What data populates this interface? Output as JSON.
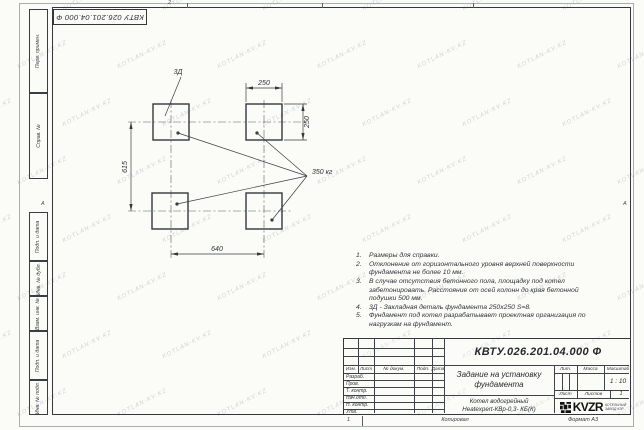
{
  "sheet": {
    "paper_color": "#fbfbf8",
    "line_color": "#3a3e42"
  },
  "stamp_top": {
    "text": "КВТУ 026.201.04.000 Ф"
  },
  "zones": {
    "top_number": "2",
    "left_letter": "А",
    "right_letter": "А"
  },
  "margin_fields": {
    "top": [
      "Перв. примен.",
      "Справ. №"
    ],
    "bottom": [
      "Подп. и дата",
      "Инв. № дубл.",
      "Взам. инв. №",
      "Подп. и дата",
      "Инв. № подл."
    ]
  },
  "drawing": {
    "embed_label": "3Д",
    "load_label": "350 кг",
    "dim_pad_width": "250",
    "dim_pad_height": "250",
    "dim_row_spacing": "615",
    "dim_col_spacing": "640"
  },
  "notes": {
    "items": [
      {
        "n": "1.",
        "text": "Размеры для справки."
      },
      {
        "n": "2.",
        "text": "Отклонение от горизонтального уровня верхней поверхности фундамента не более 10 мм."
      },
      {
        "n": "3.",
        "text": "В случае отсутствия бетонного пола, площадку под котел забетонировать. Расстояние от осей колонн до края бетонной подушки 500 мм."
      },
      {
        "n": "4.",
        "text": "3Д - Закладная деталь фундамента 250х250 S=8."
      },
      {
        "n": "5.",
        "text": "Фундамент под котел разрабатывает проектная организация по нагрузкам на фундамент."
      }
    ]
  },
  "title_block": {
    "doc_code": "КВТУ.026.201.04.000 Ф",
    "title_line1": "Задание на установку",
    "title_line2": "фундамента",
    "product_line1": "Котел водогрейный",
    "product_line2": "Heatexpert-КВр-0,3- КБ(К)",
    "header_cols": [
      "Изм.",
      "Лист",
      "№ докум.",
      "Подп.",
      "Дата"
    ],
    "sign_rows": [
      "Разраб.",
      "Пров.",
      "Т. контр.",
      "Нач.отд.",
      "Н. контр.",
      "Утв."
    ],
    "lit_label": "Лит.",
    "mass_label": "Масса",
    "scale_label": "Масштаб",
    "scale_value": "1 : 10",
    "sheet_label": "Лист",
    "sheets_label": "Листов",
    "sheets_value": "1",
    "logo_text": "KVZR",
    "logo_caption_line1": "КОТЕЛЬНЫЙ",
    "logo_caption_line2": "ЗАВОД КЗР"
  },
  "footer": {
    "fold_mark": "1",
    "copy_label": "Копировал",
    "format_label": "Формат А3"
  },
  "watermark": {
    "text": "KOTLAN-KV.KZ"
  }
}
